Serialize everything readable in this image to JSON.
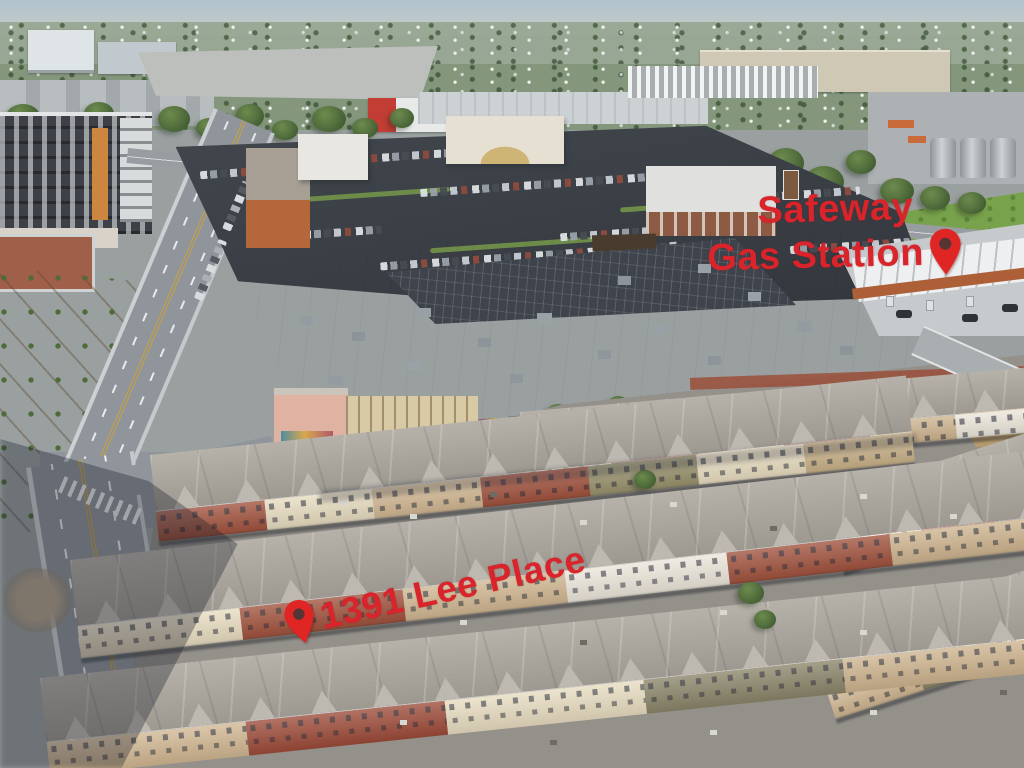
{
  "photo": {
    "description": "Aerial drone photograph of a Safeway shopping center with gas station next to a townhome community at 1391 Lee Place",
    "annotations": {
      "gas_station": {
        "line1": "Safeway",
        "line2": "Gas Station"
      },
      "address": "1391 Lee Place"
    },
    "colors": {
      "annotation_red": "#d8242a",
      "pin_red": "#e02525"
    }
  }
}
